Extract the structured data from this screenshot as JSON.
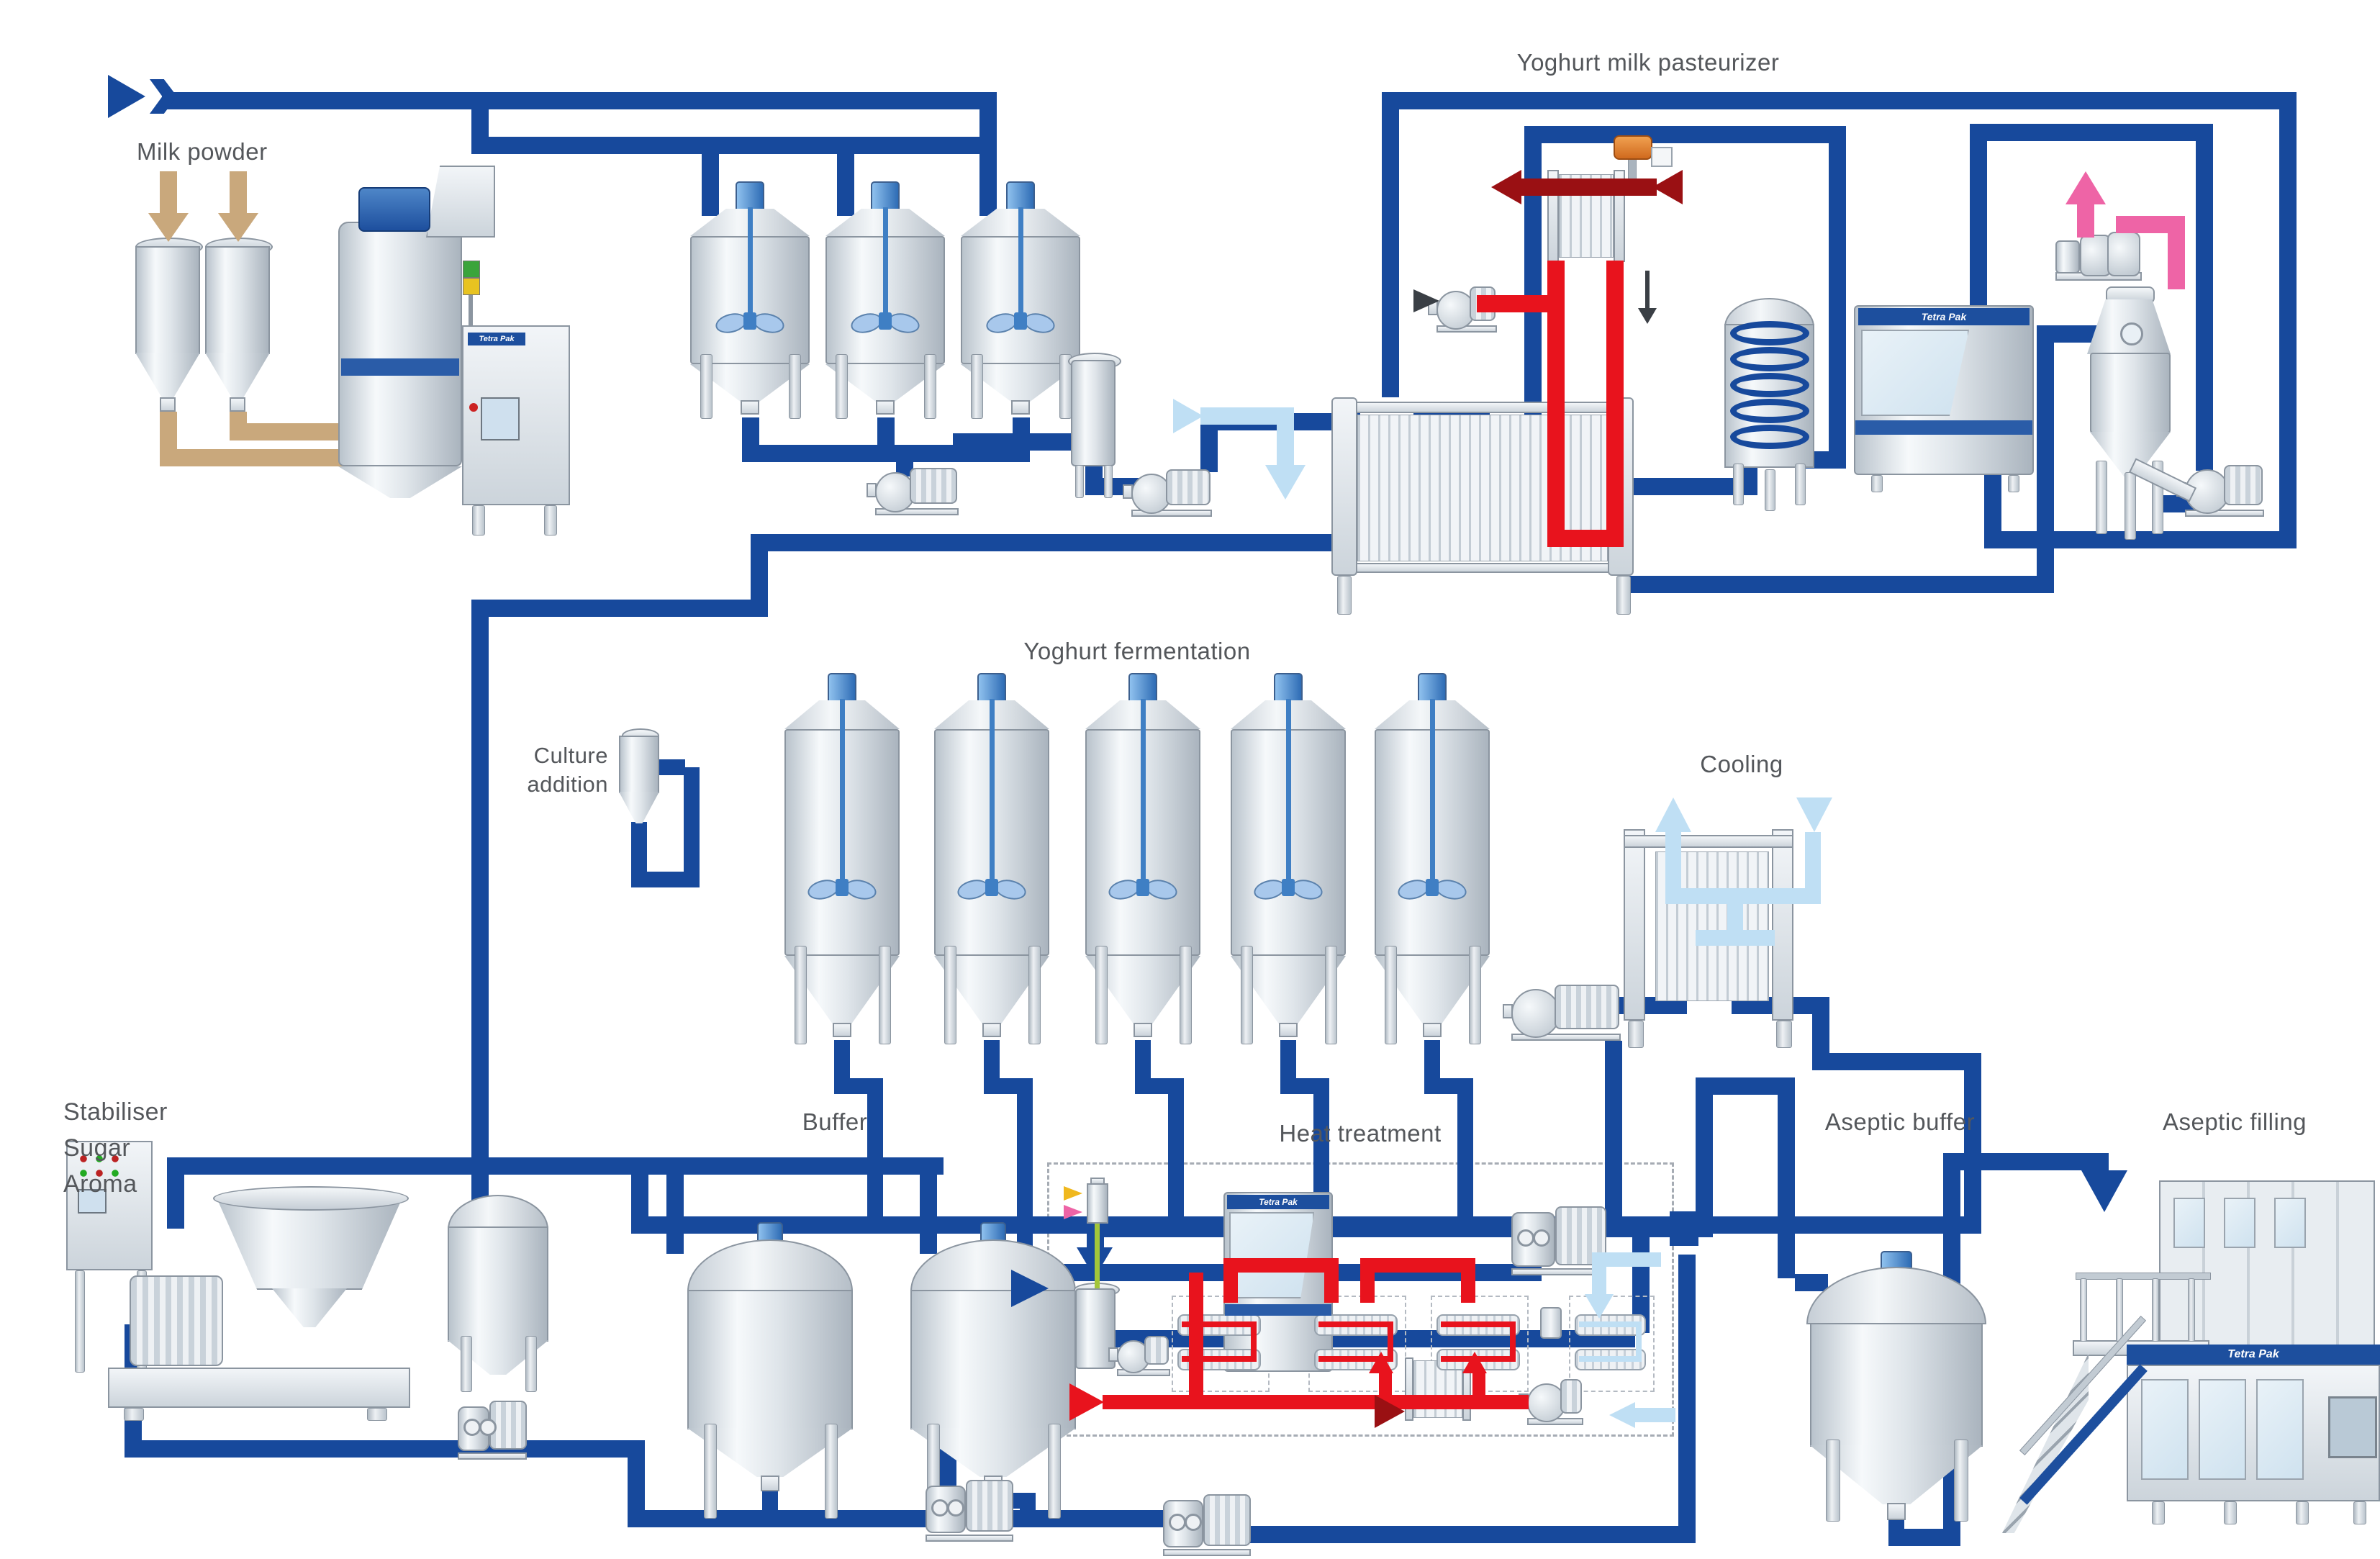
{
  "diagram": {
    "labels": {
      "milk_powder": "Milk powder",
      "pasteurizer": "Yoghurt milk pasteurizer",
      "fermentation": "Yoghurt fermentation",
      "culture_line1": "Culture",
      "culture_line2": "addition",
      "cooling": "Cooling",
      "stabiliser_line1": "Stabiliser",
      "stabiliser_line2": "Sugar",
      "stabiliser_line3": "Aroma",
      "buffer": "Buffer",
      "heat_treatment": "Heat treatment",
      "aseptic_buffer": "Aseptic buffer",
      "aseptic_filling": "Aseptic filling"
    },
    "brand": {
      "tetra_pak": "Tetra Pak"
    },
    "colors": {
      "product_pipe": "#17499c",
      "hot_water": "#e8131d",
      "steam": "#9a1013",
      "ice_water": "#bfdff4",
      "vacuum": "#ee64a6",
      "milk_powder_flow": "#c9a87c",
      "label_text": "#54575b"
    }
  }
}
